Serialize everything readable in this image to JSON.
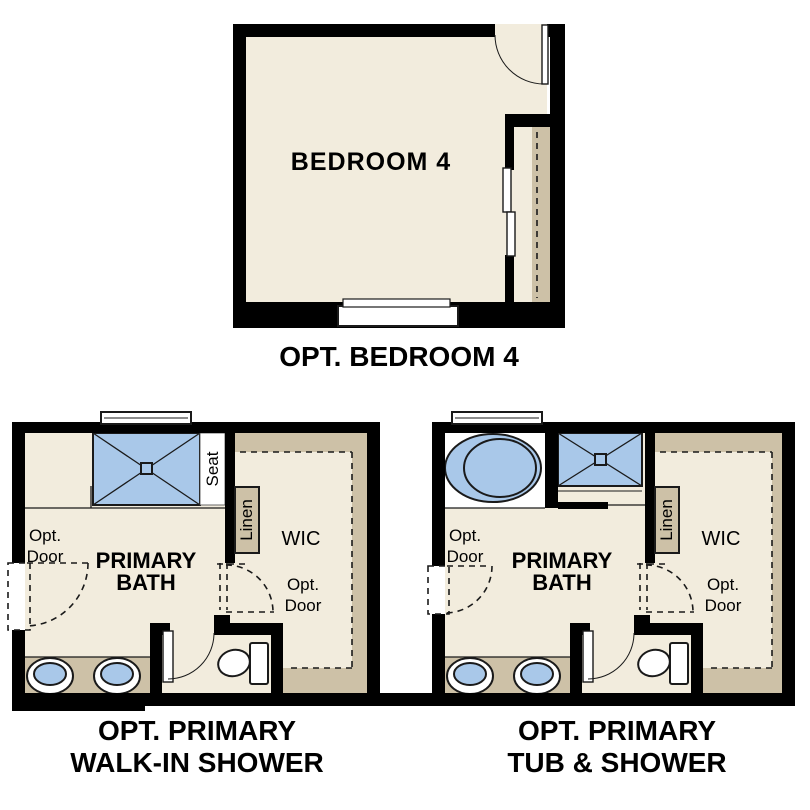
{
  "colors": {
    "wall": "#000000",
    "line": "#1a1a1a",
    "floor": "#f2ecdd",
    "tan": "#cdc1a7",
    "fixture_blue": "#a9c8e9",
    "white": "#ffffff"
  },
  "bedroom_plan": {
    "room_label": "BEDROOM 4",
    "caption": "OPT. BEDROOM 4"
  },
  "walk_in_plan": {
    "caption_line1": "OPT. PRIMARY",
    "caption_line2": "WALK-IN SHOWER",
    "room_label_line1": "PRIMARY",
    "room_label_line2": "BATH",
    "wic_label": "WIC",
    "linen_label": "Linen",
    "seat_label": "Seat",
    "opt_label": "Opt.",
    "door_label": "Door"
  },
  "tub_plan": {
    "caption_line1": "OPT. PRIMARY",
    "caption_line2": "TUB & SHOWER",
    "room_label_line1": "PRIMARY",
    "room_label_line2": "BATH",
    "wic_label": "WIC",
    "linen_label": "Linen",
    "opt_label": "Opt.",
    "door_label": "Door"
  }
}
